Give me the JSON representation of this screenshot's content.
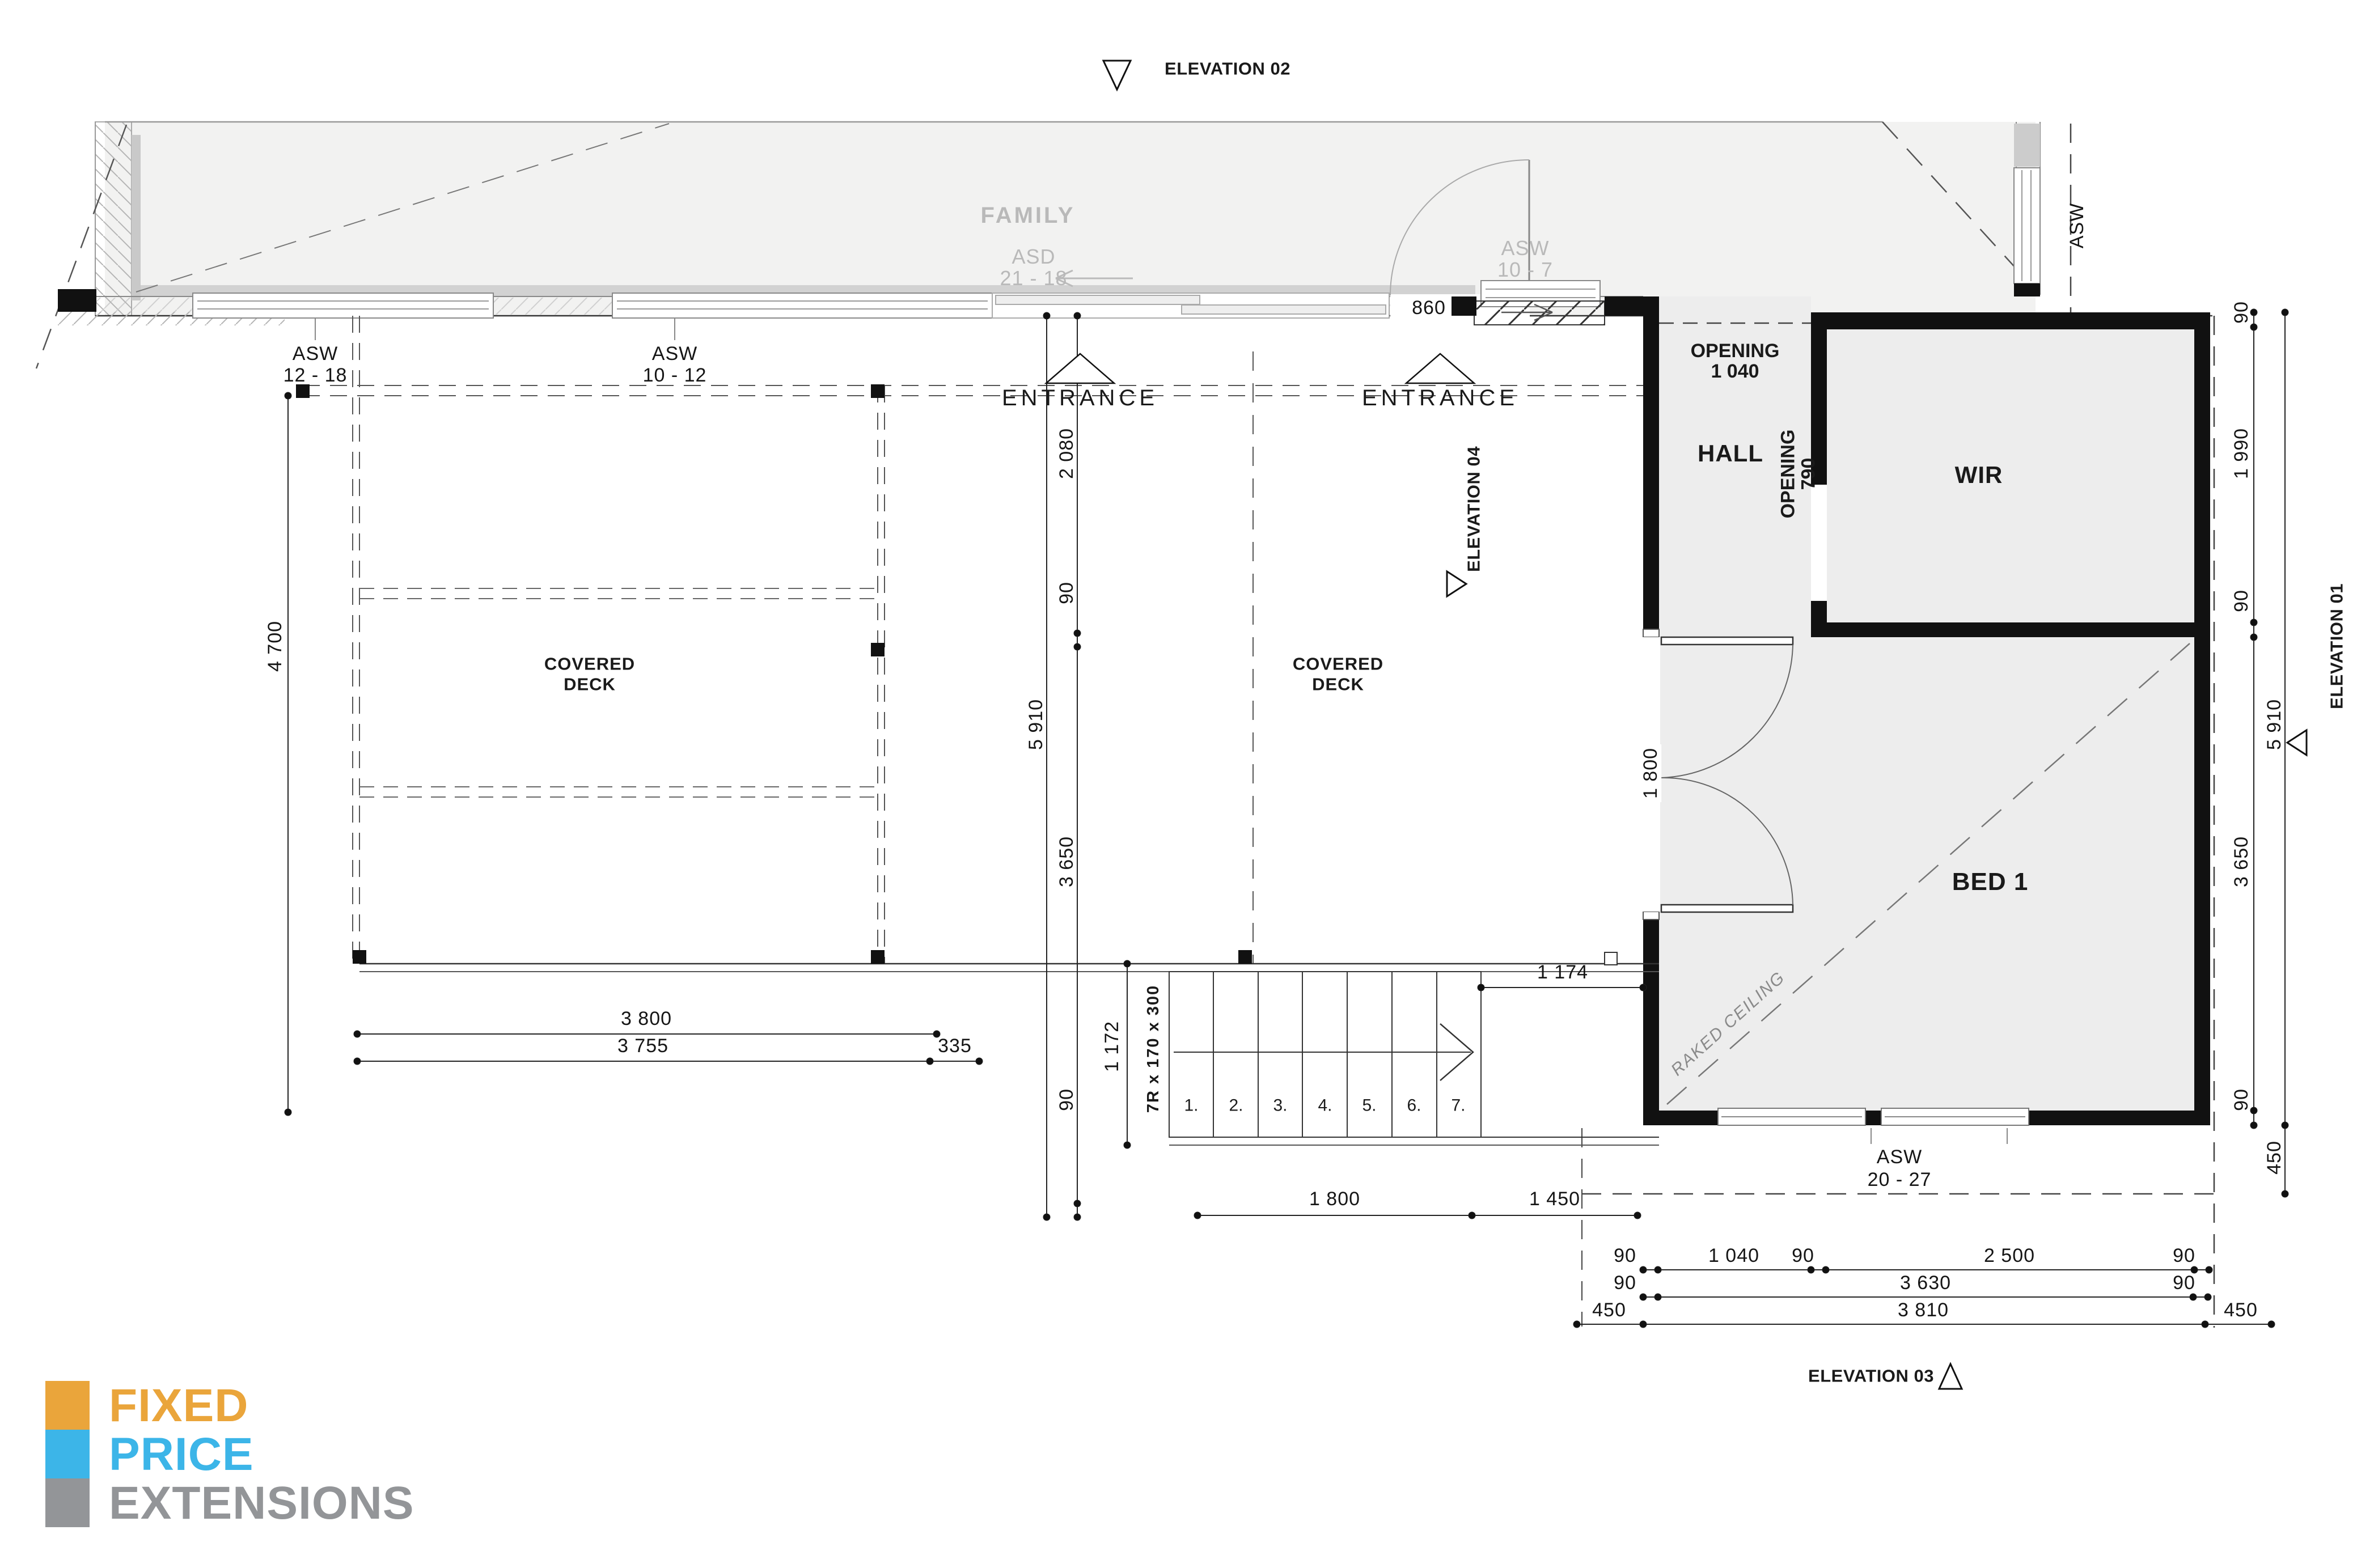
{
  "drawing": {
    "elevation_markers": {
      "e01": "ELEVATION 01",
      "e02": "ELEVATION 02",
      "e03": "ELEVATION 03",
      "e04": "ELEVATION 04"
    },
    "rooms": {
      "family": "FAMILY",
      "hall": "HALL",
      "wir": "WIR",
      "bed1": "BED 1",
      "covered_deck_line1": "COVERED",
      "covered_deck_line2": "DECK",
      "raked_ceiling": "RAKED CEILING"
    },
    "entrance_label": "ENTRANCE",
    "windows": {
      "asw_12_18": {
        "l1": "ASW",
        "l2": "12 - 18"
      },
      "asw_10_12": {
        "l1": "ASW",
        "l2": "10 - 12"
      },
      "asd_21_18": {
        "l1": "ASD",
        "l2": "21 - 18"
      },
      "asw_10_7": {
        "l1": "ASW",
        "l2": "10 - 7"
      },
      "asw_6_8": {
        "l1": "ASW",
        "l2": "6 - 8"
      },
      "asw_20_27": {
        "l1": "ASW",
        "l2": "20 - 27"
      }
    },
    "openings": {
      "o1040": {
        "l1": "OPENING",
        "l2": "1 040"
      },
      "o790": {
        "l1": "OPENING",
        "l2": "790"
      }
    },
    "stairs": {
      "note": "7R x 170 x 300",
      "steps": [
        "1.",
        "2.",
        "3.",
        "4.",
        "5.",
        "6.",
        "7."
      ]
    },
    "dimensions": {
      "d90": "90",
      "d335": "335",
      "d450": "450",
      "d860": "860",
      "d1040": "1 040",
      "d1172": "1 172",
      "d1174": "1 174",
      "d1450": "1 450",
      "d1800": "1 800",
      "d1990": "1 990",
      "d2080": "2 080",
      "d2500": "2 500",
      "d3630": "3 630",
      "d3650": "3 650",
      "d3755": "3 755",
      "d3800": "3 800",
      "d3810": "3 810",
      "d4700": "4 700",
      "d5910": "5 910"
    }
  },
  "logo": {
    "line1": "FIXED",
    "line2": "PRICE",
    "line3": "EXTENSIONS",
    "orange": "#EAA53B",
    "blue": "#3CB5E8",
    "gray": "#939598"
  }
}
